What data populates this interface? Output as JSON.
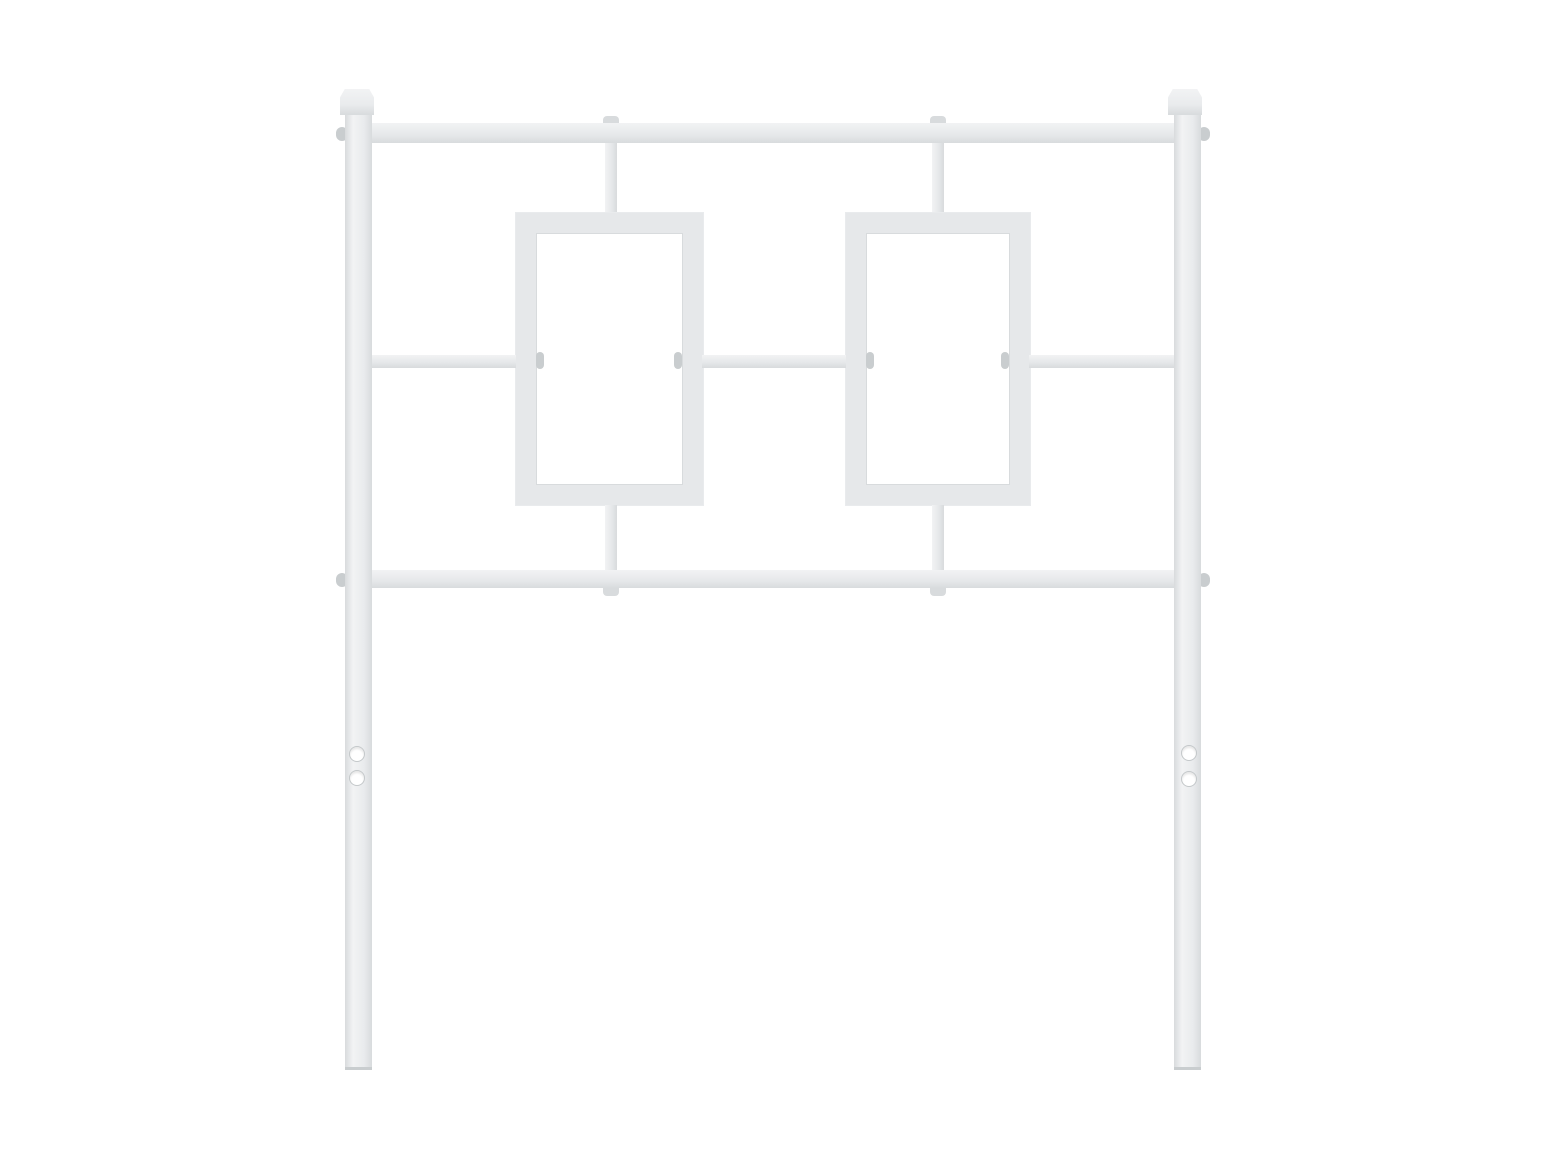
{
  "scene": {
    "type": "product-photo",
    "subject": "white metal headboard with geometric double-rectangle design",
    "description": "Plain white background; white powder-coated metal headboard with two square finial posts, top rail, middle rail, bottom rail, two rectangular decorative frames, vertical connectors, side bolts, and two mounting holes on each leg",
    "visible_text": "",
    "colors": {
      "background": "#ffffff",
      "metal": "#e9ebed",
      "metal-light": "#f2f3f4",
      "metal-mid": "#e6e8ea",
      "metal-dark": "#d8dbdd",
      "metal-edge": "#c9cdcf",
      "hole-rim": "#c4c8ca"
    },
    "counts": {
      "posts": 2,
      "finials": 2,
      "horizontal_rails": 3,
      "decorative_frames": 2,
      "mounting_holes_per_leg": 2
    }
  }
}
